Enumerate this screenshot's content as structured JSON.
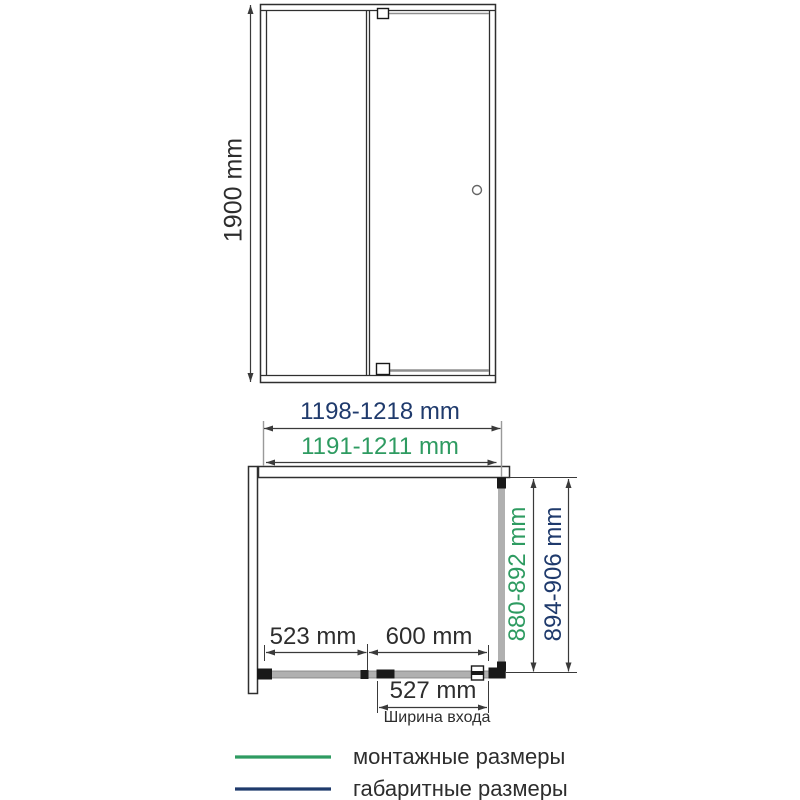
{
  "colors": {
    "mounting_green": "#2e9b61",
    "overall_navy": "#1f3a6c"
  },
  "front_view": {
    "height_label": "1900 mm"
  },
  "plan_view": {
    "overall_width_label": "1198-1218 mm",
    "mounting_width_label": "1191-1211 mm",
    "mounting_depth_label": "880-892 mm",
    "overall_depth_label": "894-906 mm",
    "fixed_segment_label": "523 mm",
    "door_segment_label": "600 mm",
    "entrance_width_label": "527 mm",
    "entrance_caption": "Ширина входа"
  },
  "legend": {
    "mounting_label": "монтажные размеры",
    "overall_label": "габаритные размеры"
  }
}
